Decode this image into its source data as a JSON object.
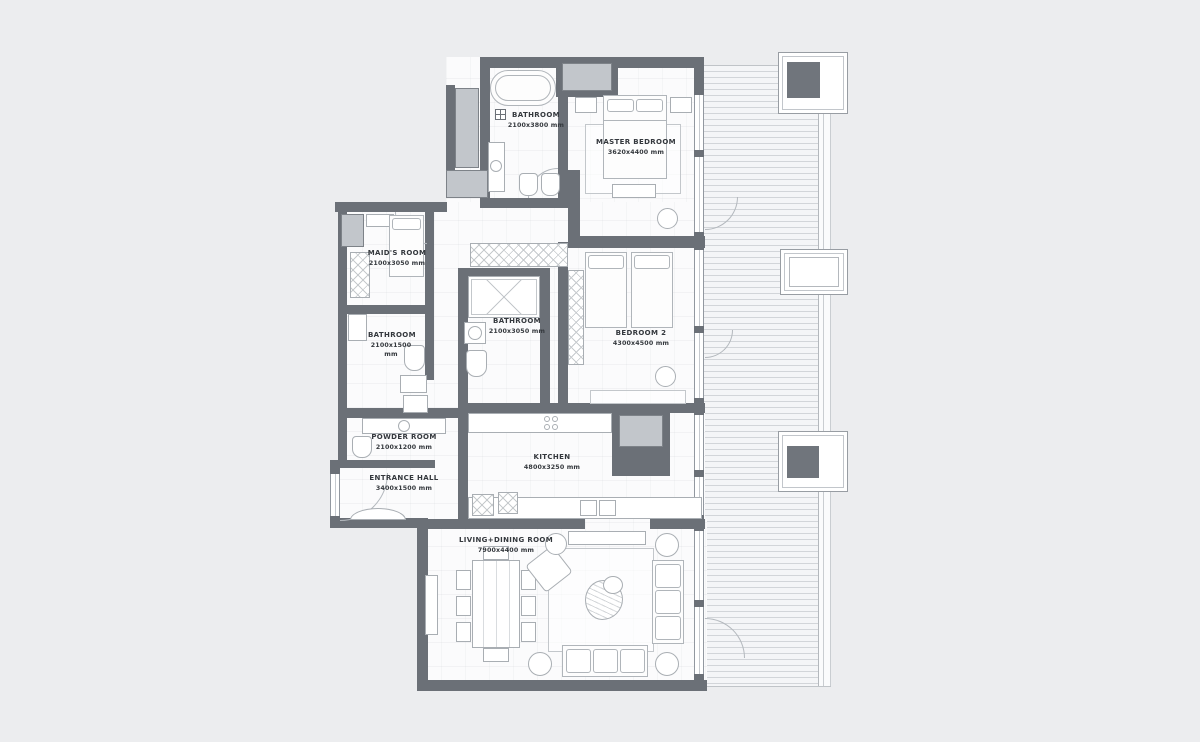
{
  "title": "Apartment floor plan",
  "colors": {
    "background": "#ecedef",
    "wall": "#6b7077",
    "floor": "#fbfbfc",
    "shaft": "#c2c6cb",
    "column_core": "#70757c",
    "label_text": "#34383d"
  },
  "rooms": [
    {
      "id": "bathroom-top",
      "name": "BATHROOM",
      "dims": "2100x3800 mm"
    },
    {
      "id": "master-bedroom",
      "name": "MASTER BEDROOM",
      "dims": "3620x4400 mm"
    },
    {
      "id": "maids-room",
      "name": "MAID'S ROOM",
      "dims": "2100x3050 mm"
    },
    {
      "id": "bathroom-mid",
      "name": "BATHROOM",
      "dims": "2100x3050 mm"
    },
    {
      "id": "bedroom-2",
      "name": "BEDROOM 2",
      "dims": "4300x4500 mm"
    },
    {
      "id": "bathroom-small",
      "name": "BATHROOM",
      "dims": "2100x1500 mm"
    },
    {
      "id": "powder-room",
      "name": "POWDER ROOM",
      "dims": "2100x1200 mm"
    },
    {
      "id": "entrance-hall",
      "name": "ENTRANCE HALL",
      "dims": "3400x1500 mm"
    },
    {
      "id": "kitchen",
      "name": "KITCHEN",
      "dims": "4800x3250 mm"
    },
    {
      "id": "living-dining",
      "name": "LIVING+DINING ROOM",
      "dims": "7900x4400 mm"
    }
  ]
}
